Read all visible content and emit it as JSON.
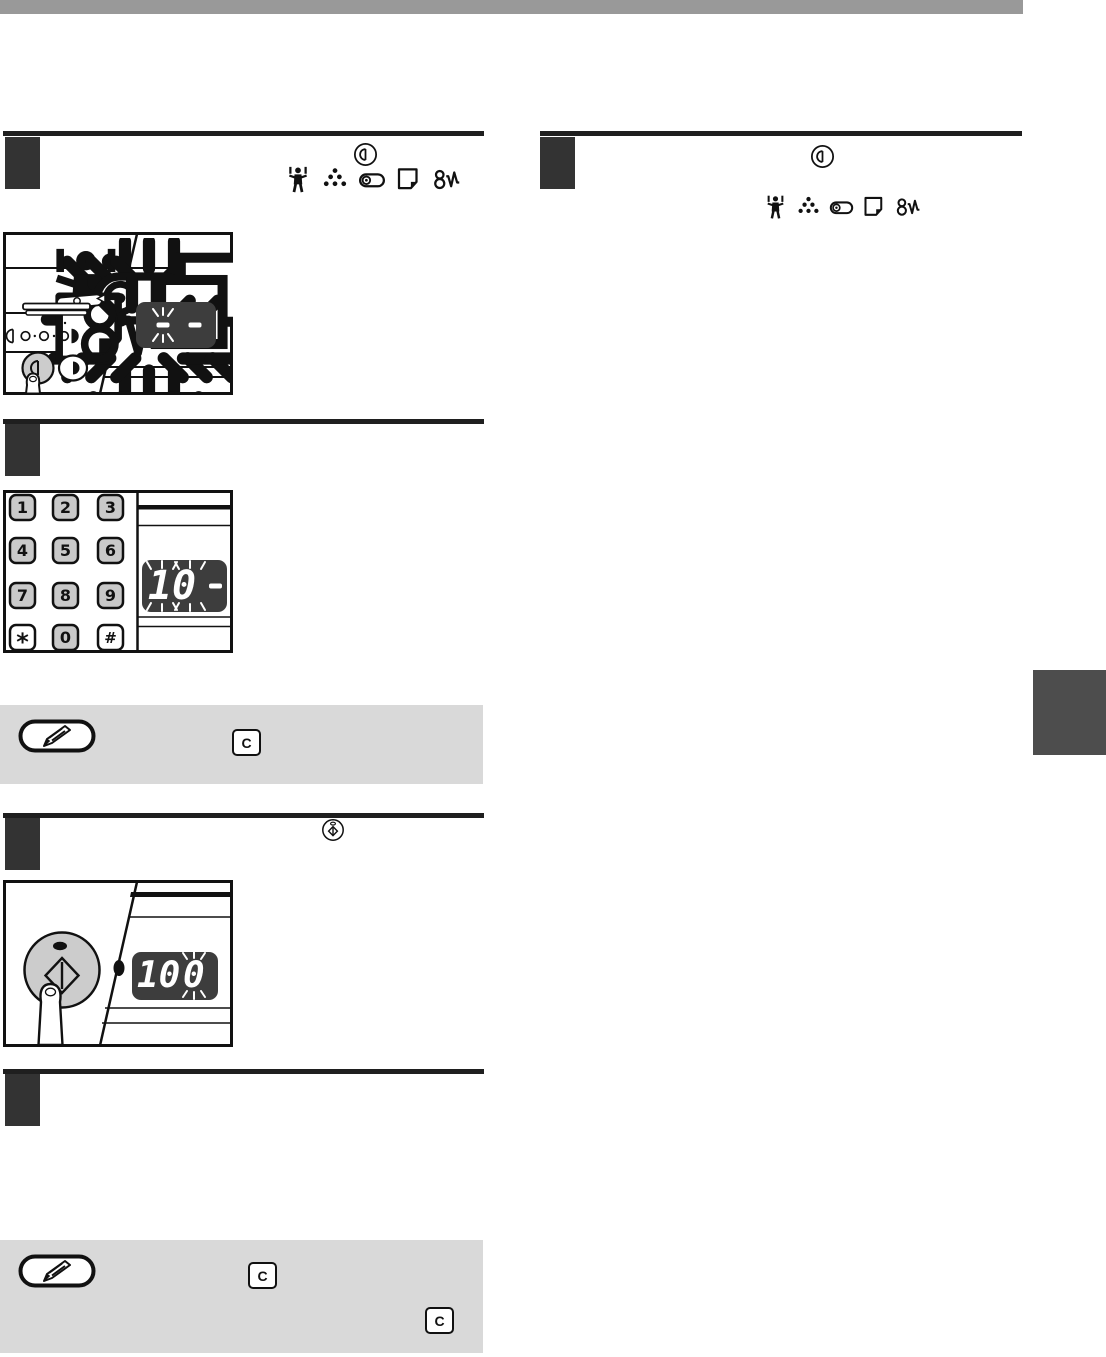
{
  "document": {
    "kind": "copier-operation-manual-page",
    "header_bar_color": "#999999",
    "side_tab_color": "#4d4d4d",
    "accent_rule_color": "#1f1f1f",
    "step_square_color": "#333333",
    "note_box_color": "#d9d9d9",
    "display_bg_color": "#3d3d3d",
    "display_segment_color": "#ffffff",
    "key_gray_color": "#c9c9c9"
  },
  "steps": [
    {
      "column": "left",
      "order": 1,
      "heading_icons": [
        "exposure-key-icon"
      ],
      "indicator_icons": [
        "maintenance-required-icon",
        "toner-cartridge-required-icon",
        "developer-required-icon",
        "paper-required-icon",
        "misfeed-icon"
      ]
    },
    {
      "column": "left",
      "order": 2,
      "heading_icons": [],
      "indicator_icons": []
    },
    {
      "column": "left",
      "order": 3,
      "heading_icons": [
        "start-key-icon"
      ],
      "indicator_icons": []
    },
    {
      "column": "left",
      "order": 4,
      "heading_icons": [],
      "indicator_icons": []
    },
    {
      "column": "right",
      "order": 1,
      "heading_icons": [
        "exposure-key-icon"
      ],
      "indicator_icons": [
        "maintenance-required-icon",
        "toner-cartridge-required-icon",
        "developer-required-icon",
        "paper-required-icon",
        "misfeed-icon"
      ]
    }
  ],
  "keypad": {
    "keys": [
      "1",
      "2",
      "3",
      "4",
      "5",
      "6",
      "7",
      "8",
      "9",
      "*",
      "0",
      "#"
    ],
    "gray_keys": [
      "1",
      "2",
      "3",
      "4",
      "5",
      "6",
      "7",
      "8",
      "9",
      "0"
    ]
  },
  "displays": {
    "exposure_panel": {
      "blinking_segment": "-",
      "steady_segment": "-"
    },
    "quantity": {
      "blinking_value": "10",
      "steady_segment": "-"
    },
    "ratio": {
      "full_value": "100",
      "steady_part": "10",
      "blinking_part": "0"
    }
  },
  "notes": [
    {
      "icon": "pencil-note-icon",
      "inline_keys": [
        "C"
      ]
    },
    {
      "icon": "pencil-note-icon",
      "inline_keys": [
        "C",
        "C"
      ]
    }
  ]
}
